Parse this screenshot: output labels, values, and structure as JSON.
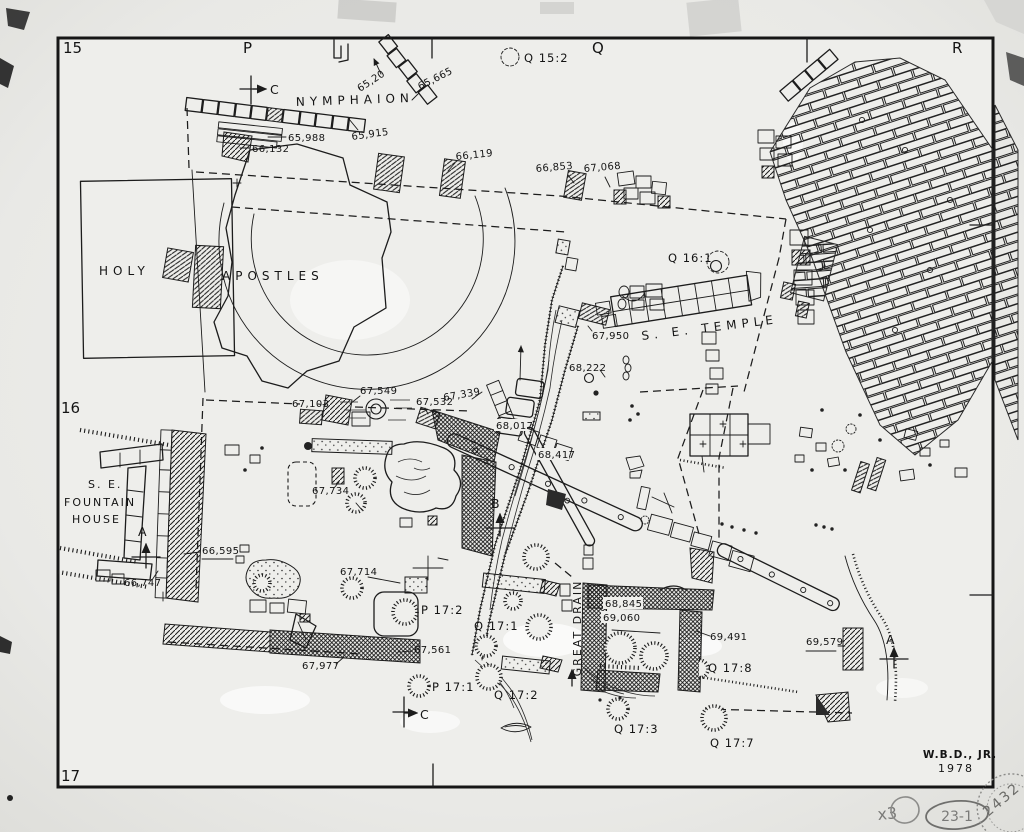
{
  "grid": {
    "row_15": "15",
    "row_16": "16",
    "row_17": "17",
    "col_p": "P",
    "col_q": "Q",
    "col_r": "R"
  },
  "monuments": {
    "nymphaion": "NYMPHAION",
    "holy": "HOLY",
    "apostles": "APOSTLES",
    "se_temple": "S. E. TEMPLE",
    "fountain_house_line1": "S. E.",
    "fountain_house_line2": "FOUNTAIN",
    "fountain_house_line3": "HOUSE",
    "great_drain": "GREAT DRAIN"
  },
  "wells": {
    "q15_2": "Q 15:2",
    "q16_1": "Q 16:1",
    "p17_1": "P 17:1",
    "p17_2": "P 17:2",
    "q17_1": "Q 17:1",
    "q17_2": "Q 17:2",
    "q17_3": "Q 17:3",
    "q17_7": "Q 17:7",
    "q17_8": "Q 17:8"
  },
  "elevations": {
    "e65_20": "65,20",
    "e65_665": "65,665",
    "e65_915": "65,915",
    "e65_988": "65,988",
    "e66_132": "66,132",
    "e66_119": "66,119",
    "e66_853": "66,853",
    "e67_068": "67,068",
    "e67_950": "67,950",
    "e68_222": "68,222",
    "e67_549": "67,549",
    "e67_532": "67,532",
    "e67_339": "67,339",
    "e67_103": "67,103",
    "e68_017": "68,017",
    "e68_417": "68,417",
    "e67_734": "67,734",
    "e67_714": "67,714",
    "e66_595": "66,595",
    "e66_747": "66,747",
    "e67_561": "67,561",
    "e67_977": "67,977",
    "e68_845": "68,845",
    "e69_060": "69,060",
    "e69_491": "69,491",
    "e69_579": "69,579"
  },
  "sections": {
    "a": "A",
    "b": "B",
    "c": "C"
  },
  "credit": {
    "drafter": "W.B.D., JR.",
    "year": "1978"
  },
  "marginalia": {
    "scale_note": "x3",
    "negative_number": "23-1",
    "stamp_number": "2432"
  }
}
